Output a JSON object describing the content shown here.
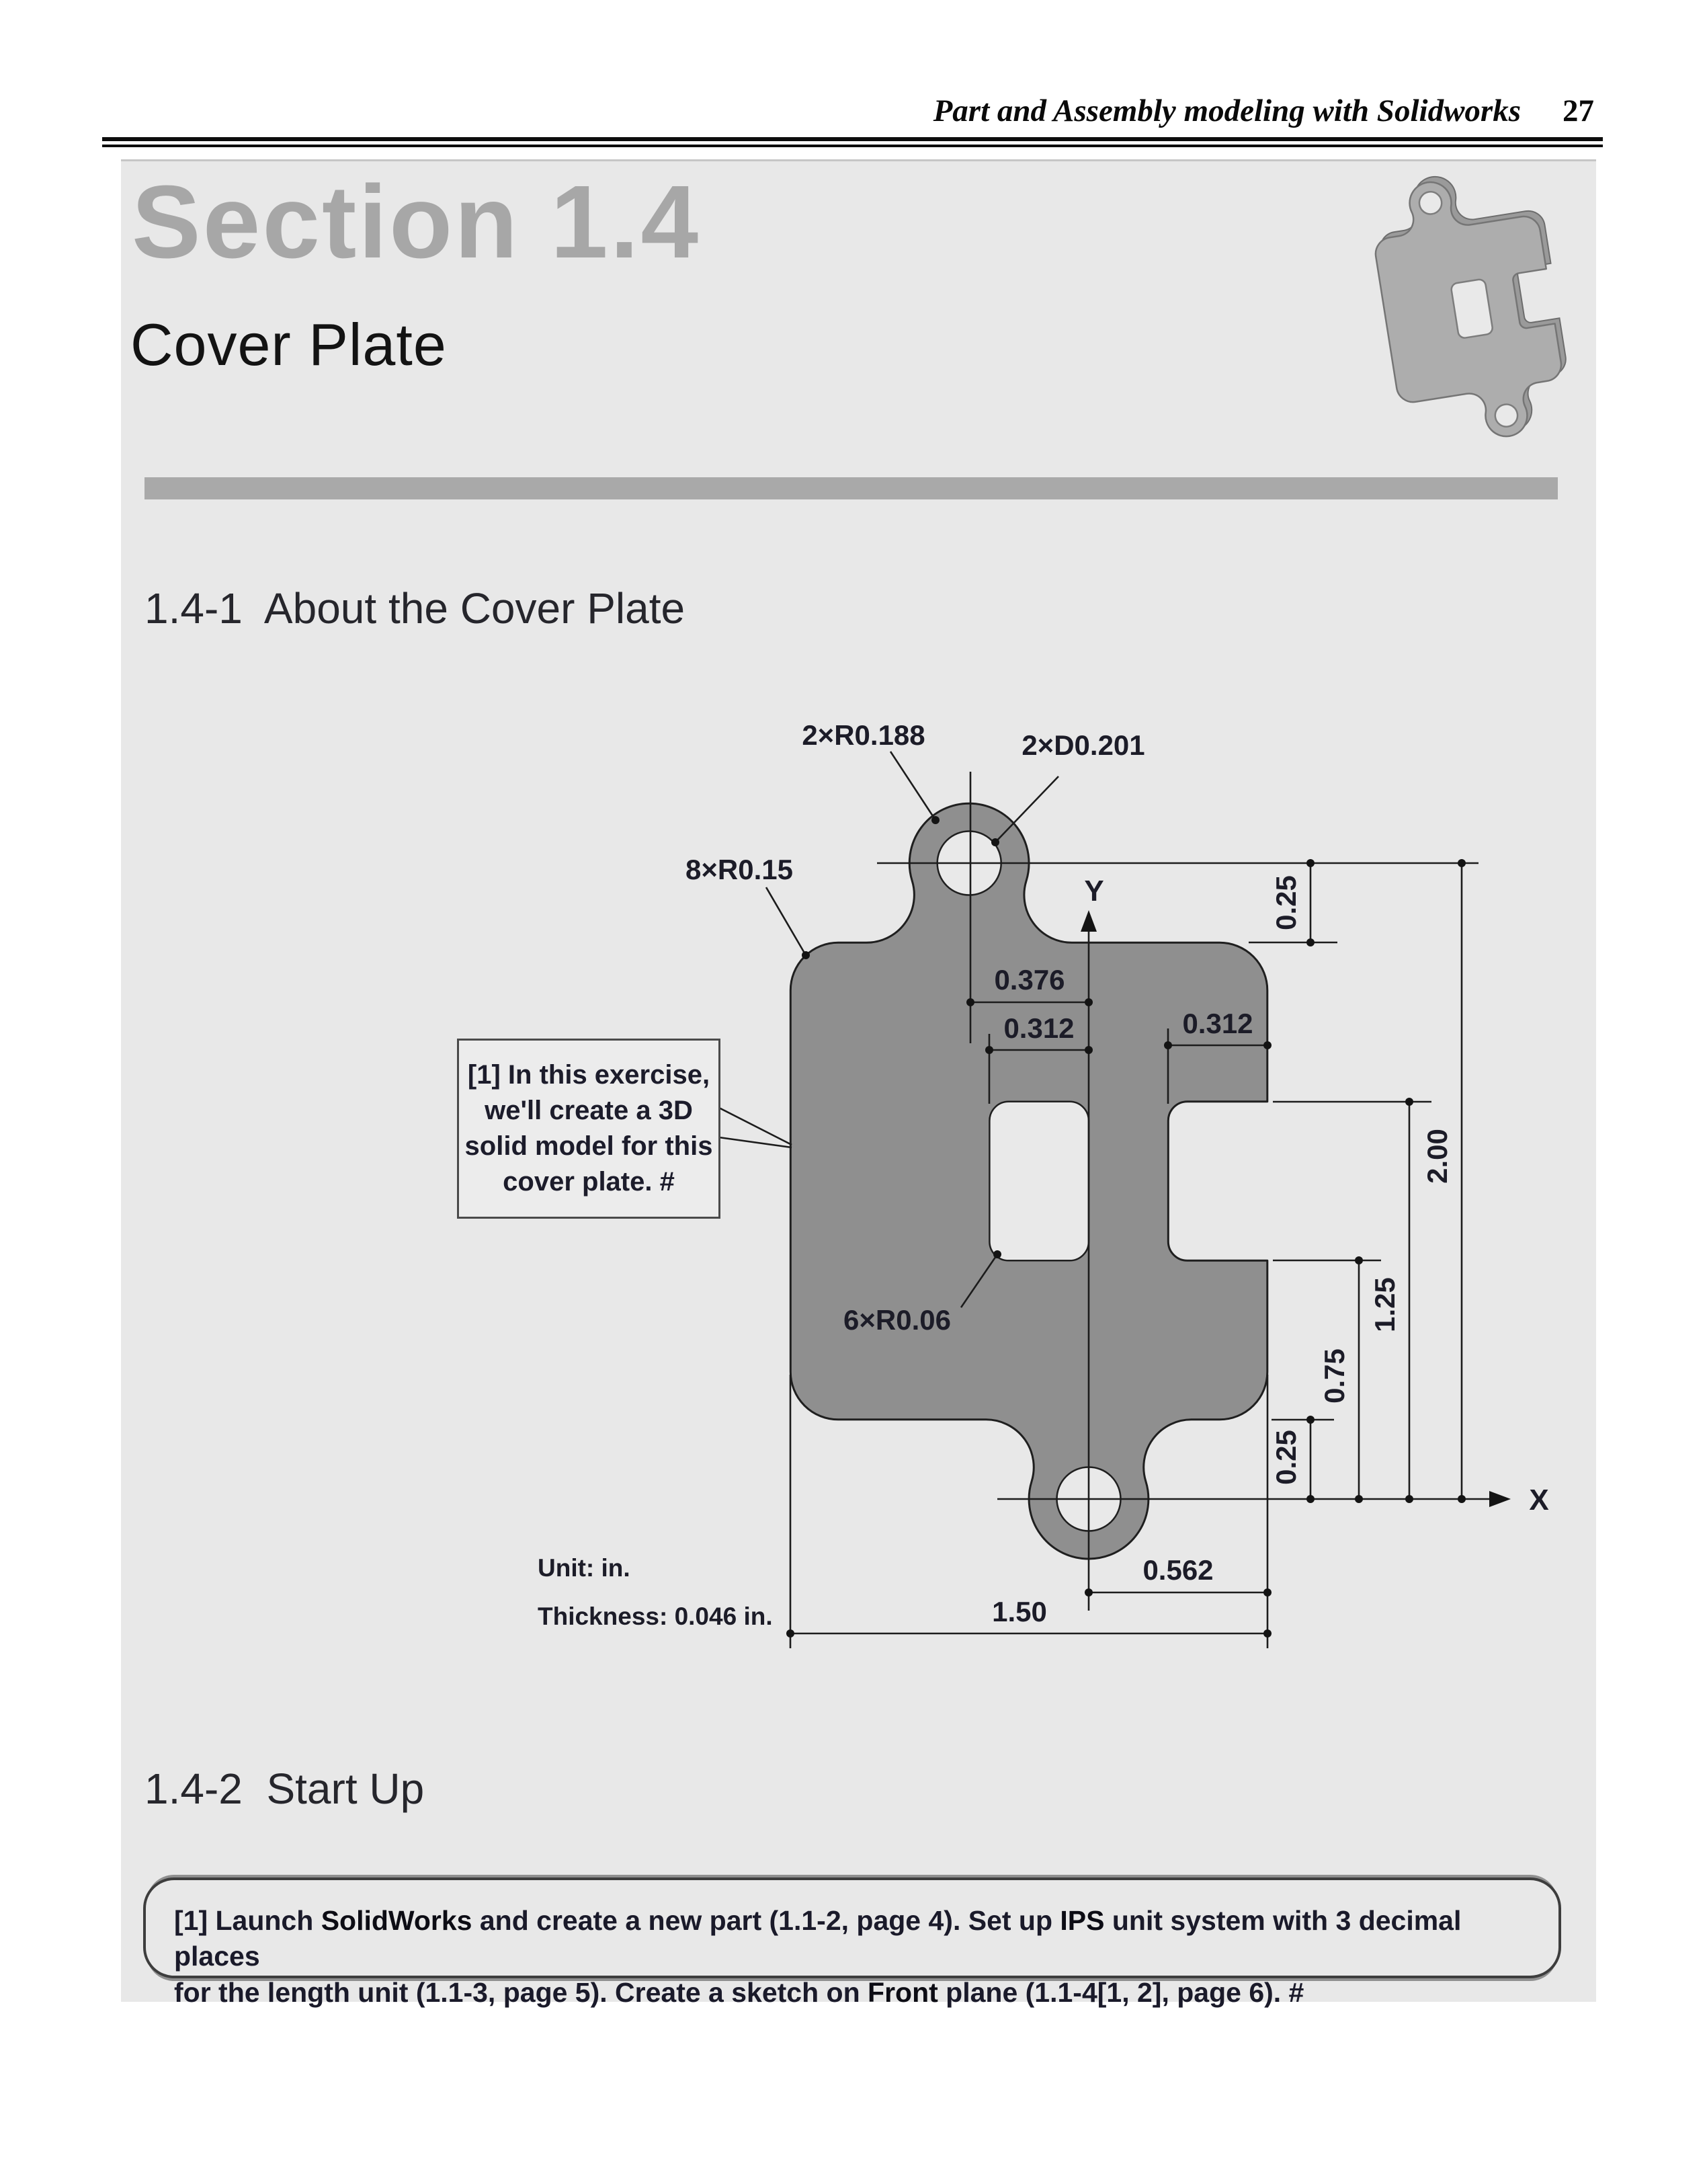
{
  "header": {
    "title": "Part and Assembly modeling with Solidworks",
    "page": "27"
  },
  "titles": {
    "section": "Section 1.4",
    "part": "Cover Plate",
    "about": "1.4-1  About the Cover Plate",
    "startup": "1.4-2  Start Up"
  },
  "drawing": {
    "dims": {
      "r188": "2×R0.188",
      "d201": "2×D0.201",
      "r15": "8×R0.15",
      "r06": "6×R0.06",
      "w376": "0.376",
      "w312l": "0.312",
      "w312r": "0.312",
      "h25t": "0.25",
      "h200": "2.00",
      "h125": "1.25",
      "h75": "0.75",
      "h25b": "0.25",
      "w562": "0.562",
      "w150": "1.50",
      "ax": "X",
      "ay": "Y"
    },
    "notes": {
      "unit": "Unit: in.",
      "thickness": "Thickness: 0.046 in."
    },
    "callout": {
      "l1": "[1] In this exercise,",
      "l2": "we'll create a 3D",
      "l3": "solid model for this",
      "l4": "cover plate. #"
    }
  },
  "instructions": {
    "s0": "[1] Launch ",
    "s1": "SolidWorks",
    "s2": " and create a new part (1.1-2, page 4).  Set up ",
    "s3": "IPS",
    "s4": " unit system with 3 decimal places",
    "s5": "for the length unit (1.1-3, page 5).  Create a sketch on ",
    "s6": "Front",
    "s7": " plane (1.1-4[1, 2], page 6). #"
  },
  "colors": {
    "panel": "#e8e8e8",
    "plate_fill": "#8f8f8f",
    "ink": "#1c1c1c",
    "divider": "#a9a9a9",
    "section_title": "#a7a7a7"
  }
}
